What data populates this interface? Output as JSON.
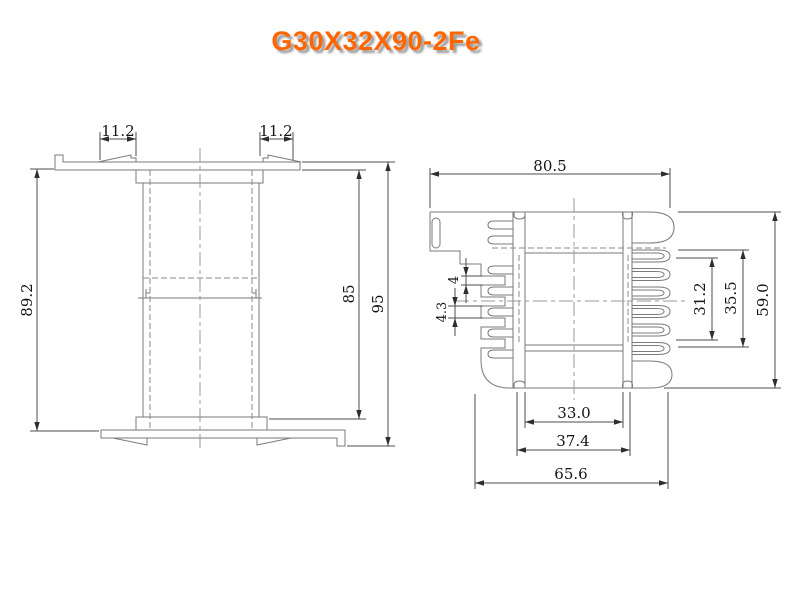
{
  "title": "G30X32X90-2Fe",
  "colors": {
    "title": "#ff6600",
    "title_shadow": "#9b9b9b",
    "geometry_line": "#7a7a7a",
    "dimension_line": "#4d4d4d",
    "dimension_text": "#151515",
    "background": "#ffffff"
  },
  "front_view": {
    "dims": {
      "tab_left": "11.2",
      "tab_right": "11.2",
      "flange_span": "89.2",
      "inner_height": "85",
      "overall_height": "95"
    }
  },
  "side_view": {
    "dims": {
      "overall_width": "80.5",
      "pin_gap": "4",
      "pin_width": "4.3",
      "window_height": "31.2",
      "slot_span": "35.5",
      "overall_height": "59.0",
      "core_width": "33.0",
      "flange_span": "37.4",
      "body_width": "65.6"
    }
  }
}
